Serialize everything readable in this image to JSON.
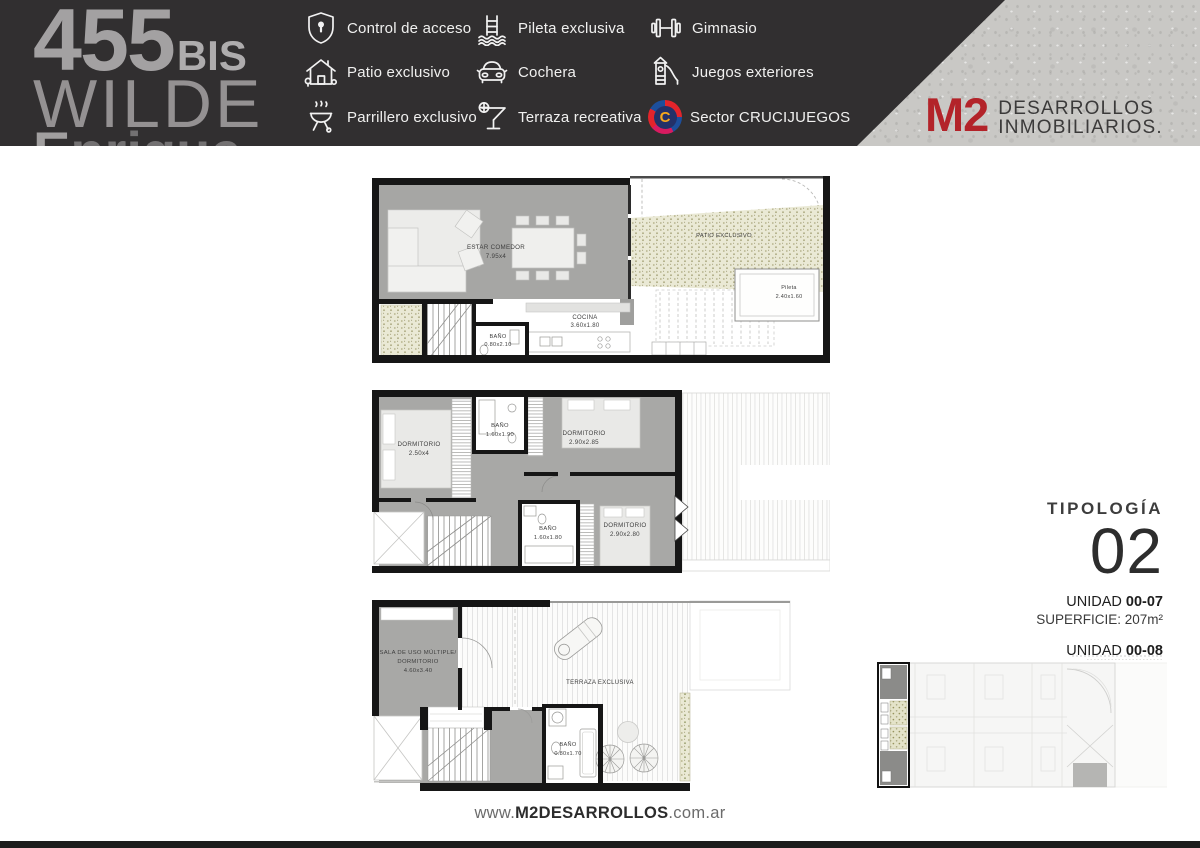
{
  "header": {
    "logo": {
      "number": "455",
      "suffix": "BIS",
      "city": "WILDE",
      "street_clipped_first": "E",
      "street_clipped_rest": "nrique"
    },
    "amenities": [
      {
        "icon": "access-control-icon",
        "label": "Control de acceso"
      },
      {
        "icon": "pool-icon",
        "label": "Pileta exclusiva"
      },
      {
        "icon": "gym-icon",
        "label": "Gimnasio"
      },
      {
        "icon": "patio-icon",
        "label": "Patio exclusivo"
      },
      {
        "icon": "car-icon",
        "label": "Cochera"
      },
      {
        "icon": "playground-icon",
        "label": "Juegos exteriores"
      },
      {
        "icon": "grill-icon",
        "label": "Parrillero exclusivo"
      },
      {
        "icon": "terrace-icon",
        "label": "Terraza recreativa"
      },
      {
        "icon": "crucijuegos-icon",
        "label": "Sector CRUCIJUEGOS",
        "badge_letter": "C"
      }
    ],
    "brand": {
      "mark": "M2",
      "line1": "DESARROLLOS",
      "line2": "INMOBILIARIOS."
    }
  },
  "plans": {
    "ground_floor": {
      "rooms": [
        {
          "label": "ESTAR COMEDOR",
          "dims": "7.95x4"
        },
        {
          "label": "COCINA",
          "dims": "3.60x1.80"
        },
        {
          "label": "BAÑO",
          "dims": "0.80x2.10"
        },
        {
          "label": "PATIO EXCLUSIVO",
          "dims": ""
        },
        {
          "label": "Pileta",
          "dims": "2.40x1.60"
        }
      ]
    },
    "first_floor": {
      "rooms": [
        {
          "label": "DORMITORIO",
          "dims": "2.50x4"
        },
        {
          "label": "BAÑO",
          "dims": "1.60x1.90"
        },
        {
          "label": "DORMITORIO",
          "dims": "2.90x2.85"
        },
        {
          "label": "BAÑO",
          "dims": "1.60x1.80"
        },
        {
          "label": "DORMITORIO",
          "dims": "2.90x2.80"
        }
      ]
    },
    "roof_floor": {
      "rooms": [
        {
          "label": "SALA DE USO MÚLTIPLE/",
          "label2": "DORMITORIO",
          "dims": "4.60x3.40"
        },
        {
          "label": "TERRAZA EXCLUSIVA",
          "dims": ""
        },
        {
          "label": "BAÑO",
          "dims": "0.80x1.70"
        }
      ]
    }
  },
  "typology": {
    "heading": "TIPOLOGÍA",
    "number": "02",
    "units": [
      {
        "label": "UNIDAD",
        "code": "00-07",
        "area": "SUPERFICIE: 207m²"
      },
      {
        "label": "UNIDAD",
        "code": "00-08",
        "area": "SUPERFICIE: 207 m²"
      }
    ]
  },
  "footer": {
    "www": "www.",
    "domain": "M2DESARROLLOS",
    "tld": ".com.ar"
  },
  "colors": {
    "accent_red": "#b32329",
    "header_bg": "#312f30",
    "concrete": "#c9c8c5",
    "wall_black": "#161616",
    "floor_gray": "#a8a8a6",
    "patio_olive": "#eae9d5"
  }
}
